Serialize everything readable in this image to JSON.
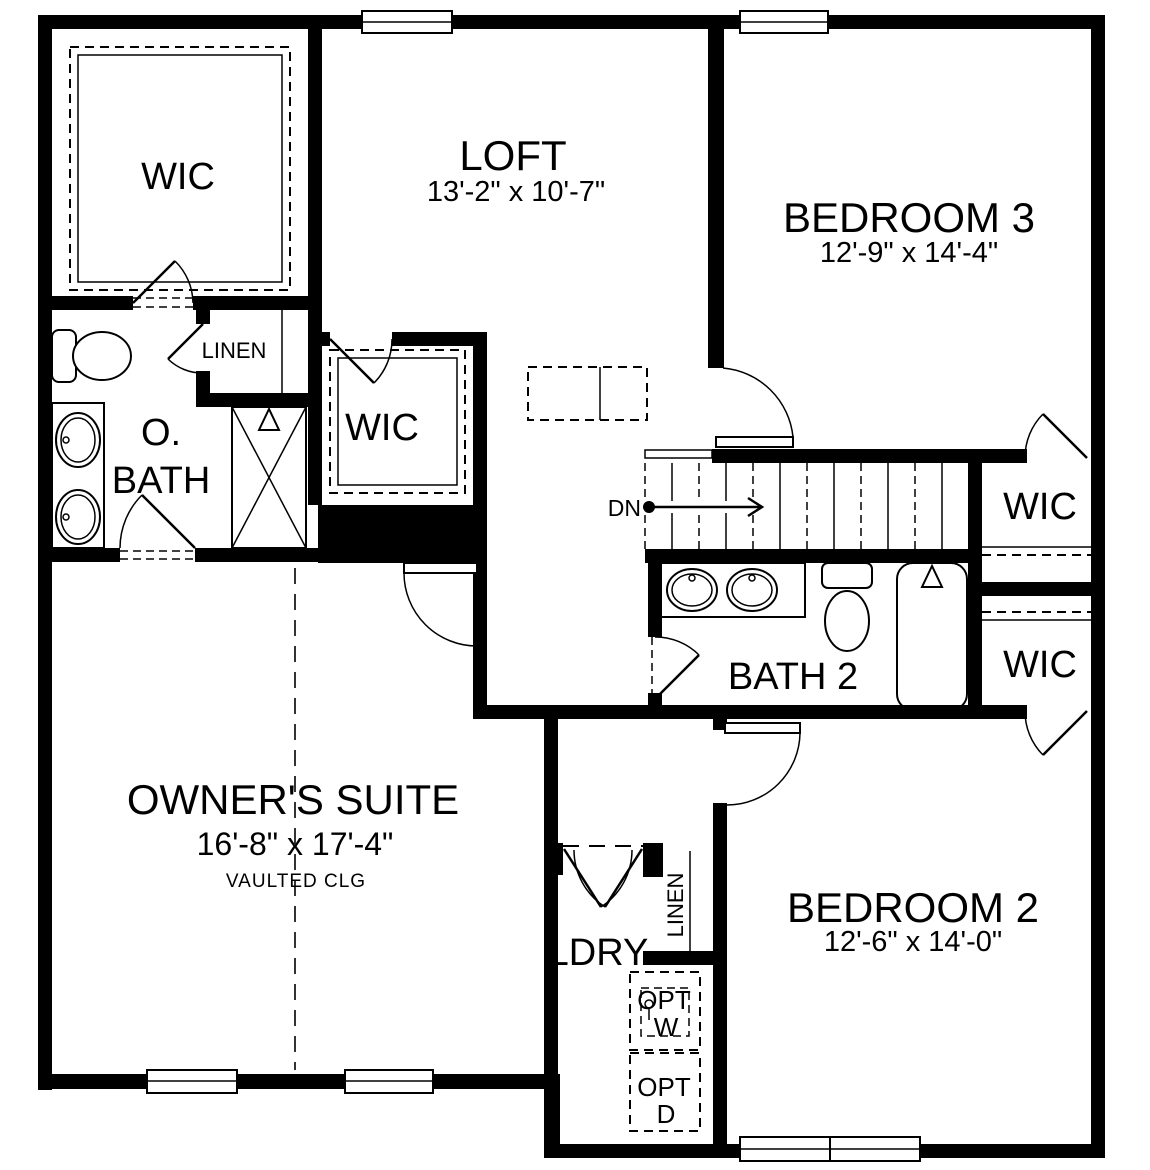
{
  "colors": {
    "wall": "#000000",
    "background": "#ffffff",
    "line": "#000000"
  },
  "rooms": {
    "wic_top_left": {
      "label": "WIC"
    },
    "loft": {
      "label": "LOFT",
      "dims": "13'-2\" x 10'-7\""
    },
    "bedroom3": {
      "label": "BEDROOM 3",
      "dims": "12'-9\" x 14'-4\""
    },
    "linen_upper": {
      "label": "LINEN"
    },
    "owners_bath": {
      "line1": "O.",
      "line2": "BATH"
    },
    "wic_middle": {
      "label": "WIC"
    },
    "wic_right_upper": {
      "label": "WIC"
    },
    "wic_right_lower": {
      "label": "WIC"
    },
    "bath2": {
      "label": "BATH 2"
    },
    "owners_suite": {
      "label": "OWNER'S SUITE",
      "dims": "16'-8\" x 17'-4\"",
      "note": "VAULTED CLG"
    },
    "laundry": {
      "label": "LDRY"
    },
    "linen_laundry": {
      "label": "LINEN"
    },
    "opt_washer": {
      "line1": "OPT",
      "line2": "W"
    },
    "opt_dryer": {
      "line1": "OPT",
      "line2": "D"
    },
    "bedroom2": {
      "label": "BEDROOM 2",
      "dims": "12'-6\" x 14'-0\""
    }
  },
  "stairs": {
    "dn_label": "DN",
    "direction": "down"
  },
  "icons": [
    "toilet-icon",
    "sink-icon",
    "shower-icon",
    "bathtub-icon",
    "window-icon",
    "door-swing-icon",
    "stairs-icon",
    "down-arrow-icon",
    "washer-opt-icon",
    "dryer-opt-icon",
    "closet-shelf-icon"
  ]
}
